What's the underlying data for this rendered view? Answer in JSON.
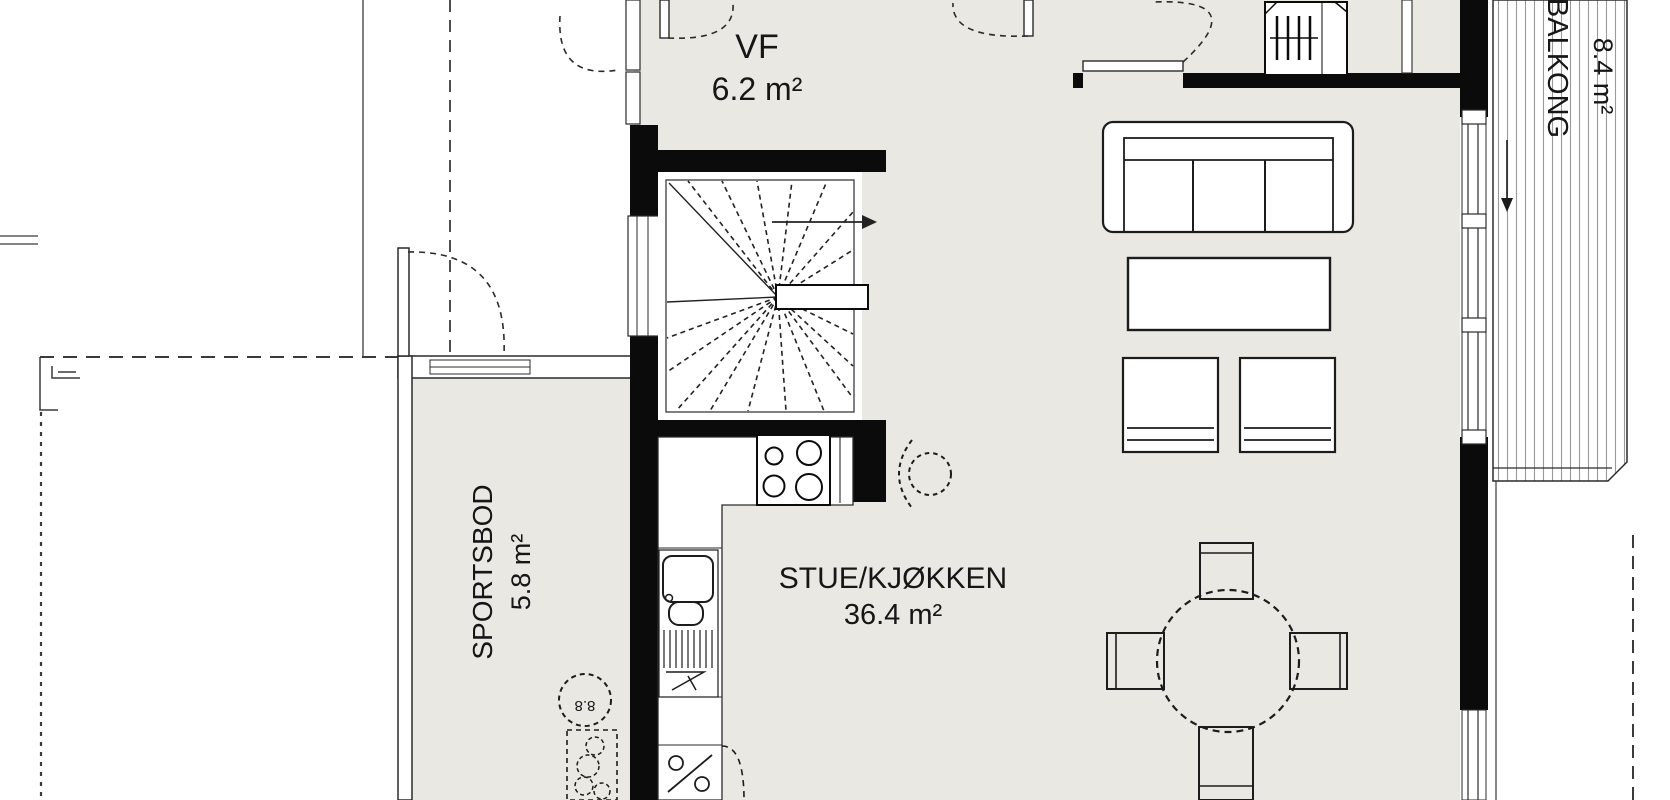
{
  "plan": {
    "title": "Floor plan",
    "rooms": [
      {
        "id": "vf",
        "label": "VF",
        "area": "6.2 m²"
      },
      {
        "id": "stue_kjokken",
        "label": "STUE/KJØKKEN",
        "area": "36.4 m²"
      },
      {
        "id": "sportsbod",
        "label": "SPORTSBOD",
        "area": "5.8 m²"
      },
      {
        "id": "balkong",
        "label": "BALKONG",
        "area": "8.4 m²"
      }
    ],
    "annotations": {
      "circle_note": "8.8"
    },
    "colors": {
      "wall": "#0b0b0b",
      "interior": "#e9e8e3",
      "outline": "#2b2b2b",
      "hatch": "#9a9a9a"
    }
  }
}
